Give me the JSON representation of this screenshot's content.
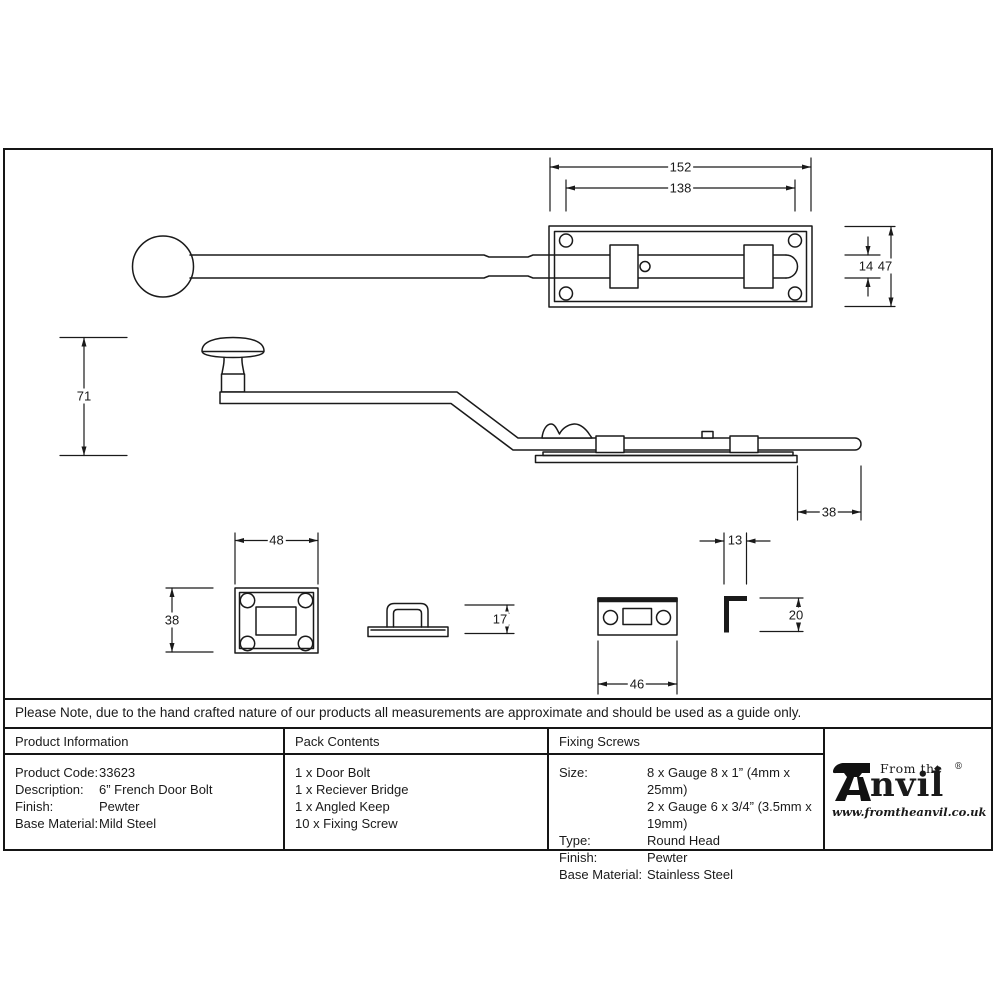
{
  "drawing": {
    "dims": {
      "plate_width": "152",
      "hole_spacing": "138",
      "bolt_width": "14",
      "plate_height": "47",
      "knob_height": "71",
      "bolt_throw": "38",
      "keep_plate_width": "48",
      "keep_plate_height": "38",
      "receiver_bridge_height": "17",
      "flat_keep_width": "46",
      "angled_keep_width": "13",
      "angled_keep_height": "20"
    }
  },
  "note": {
    "text": "Please Note, due to the hand crafted nature of our products all measurements are approximate and should be used as a guide only."
  },
  "table": {
    "product_information": {
      "header": "Product Information",
      "rows": [
        {
          "label": "Product Code:",
          "value": "33623"
        },
        {
          "label": "Description:",
          "value": "6” French Door Bolt"
        },
        {
          "label": "Finish:",
          "value": "Pewter"
        },
        {
          "label": "Base Material:",
          "value": "Mild Steel"
        }
      ]
    },
    "pack_contents": {
      "header": "Pack Contents",
      "items": [
        "1 x Door Bolt",
        "1 x Reciever Bridge",
        "1 x Angled Keep",
        "10 x Fixing Screw"
      ]
    },
    "fixing_screws": {
      "header": "Fixing Screws",
      "rows": [
        {
          "label": "Size:",
          "value": "8 x Gauge 8 x 1” (4mm x 25mm)"
        },
        {
          "label": "",
          "value": "2 x Gauge 6 x 3/4” (3.5mm x 19mm)"
        },
        {
          "label": "Type:",
          "value": "Round Head"
        },
        {
          "label": "Finish:",
          "value": "Pewter"
        },
        {
          "label": "Base Material:",
          "value": "Stainless Steel"
        }
      ]
    }
  },
  "logo": {
    "tagline": "From the",
    "name_rest": "nvil",
    "registered": "®",
    "diamond": "◆",
    "url": "www.fromtheanvil.co.uk"
  },
  "colors": {
    "ink": "#1a1a1a"
  }
}
